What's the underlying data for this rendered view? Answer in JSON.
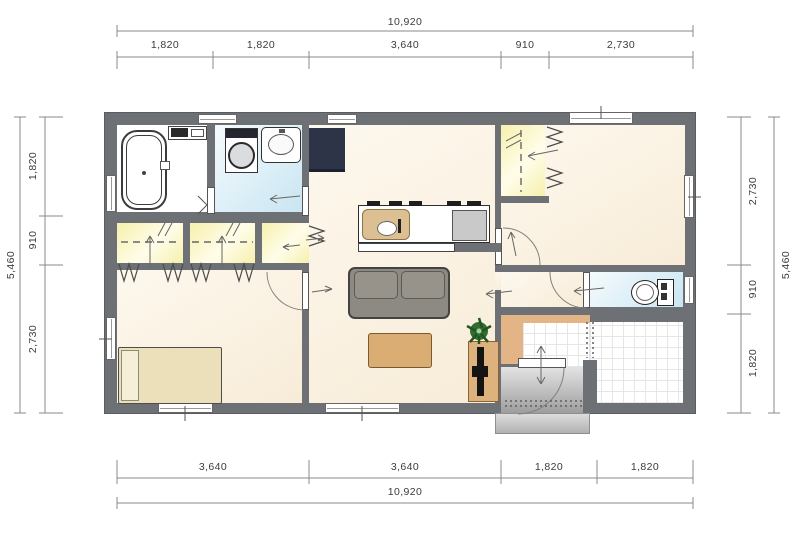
{
  "dims": {
    "top": {
      "total": "10,920",
      "segments": [
        "1,820",
        "1,820",
        "3,640",
        "910",
        "2,730"
      ]
    },
    "bottom": {
      "total": "10,920",
      "segments": [
        "3,640",
        "3,640",
        "1,820",
        "1,820"
      ]
    },
    "left": {
      "total": "5,460",
      "segments": [
        "1,820",
        "910",
        "2,730"
      ]
    },
    "right": {
      "total": "5,460",
      "segments": [
        "2,730",
        "910",
        "1,820"
      ]
    }
  },
  "colors": {
    "wall": "#6d7175",
    "cream-a": "#fdf8ee",
    "cream-b": "#f8ecd8",
    "wet-a": "#f5fbfd",
    "wet-b": "#c9e5f2",
    "closet-a": "#f6f0ac",
    "closet-b": "#fffdea",
    "tile-line": "#e6e6e6",
    "step-wood": "#e3b486",
    "porch-a": "#e3e3e3",
    "porch-b": "#9e9e9e",
    "fridge": "#2d3447",
    "sofa": "#8d8983",
    "table": "#d9ad74",
    "bed": "#ece0bb",
    "tv-board": "#ddb27c",
    "plant": "#2f6d30",
    "dim-text": "#3c3c3c",
    "line": "#8a8a8a"
  }
}
